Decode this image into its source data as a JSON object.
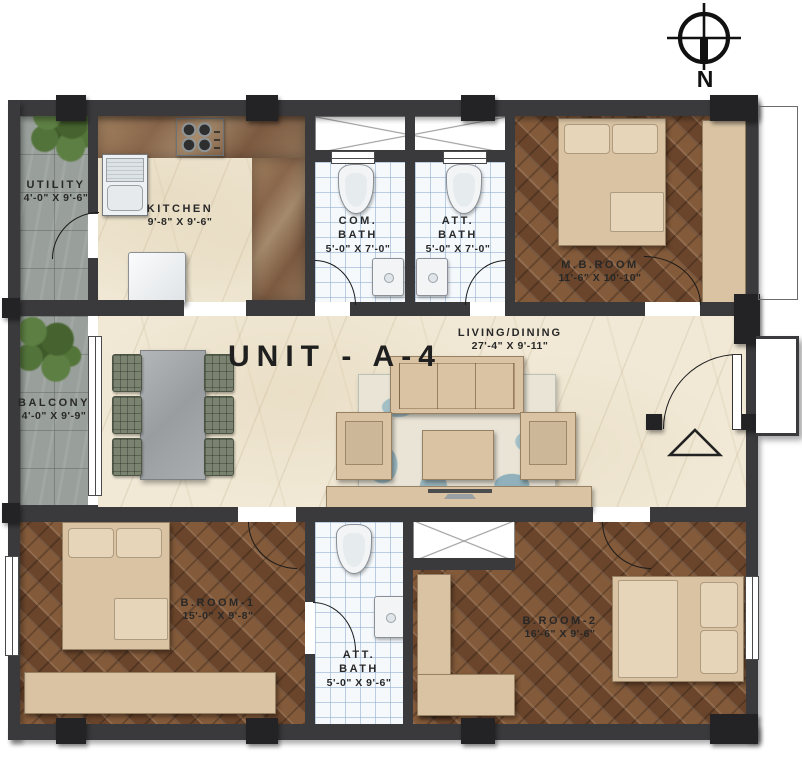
{
  "unit_label": "UNIT - A-4",
  "compass": {
    "label": "N"
  },
  "rooms": {
    "utility": {
      "name": "UTILITY",
      "dims": "4'-0\" X 9'-6\""
    },
    "kitchen": {
      "name": "KITCHEN",
      "dims": "9'-8\" X 9'-6\""
    },
    "com_bath": {
      "name_line1": "COM.",
      "name_line2": "BATH",
      "dims": "5'-0\" X 7'-0\""
    },
    "att_bath_top": {
      "name_line1": "ATT.",
      "name_line2": "BATH",
      "dims": "5'-0\" X 7'-0\""
    },
    "mb_room": {
      "name": "M.B.ROOM",
      "dims": "11'-6\" X 10'-10\""
    },
    "living_dining": {
      "name": "LIVING/DINING",
      "dims": "27'-4\" X 9'-11\""
    },
    "balcony": {
      "name": "BALCONY",
      "dims": "4'-0\" X 9'-9\""
    },
    "b_room_1": {
      "name": "B.ROOM-1",
      "dims": "15'-0\" X 9'-8\""
    },
    "att_bath_bottom": {
      "name_line1": "ATT.",
      "name_line2": "BATH",
      "dims": "5'-0\" X 9'-6\""
    },
    "b_room_2": {
      "name": "B.ROOM-2",
      "dims": "16'-6\" X 9'-6\""
    }
  },
  "icons": {
    "compass": "north-compass",
    "entry_marker": "entry-triangle",
    "plants": "potted-plant"
  },
  "colors": {
    "wall": "#3a3a3c",
    "wood_floor": "#714b30",
    "gray_tile": "#99a09b",
    "cream_marble": "#f1e9d6",
    "counter_brown": "#8a674c",
    "bath_tile": "#f5f9fc",
    "furniture_tan": "#d9c3a3",
    "plant_green": "#52733a",
    "rug_blue": "#92b2bd"
  }
}
